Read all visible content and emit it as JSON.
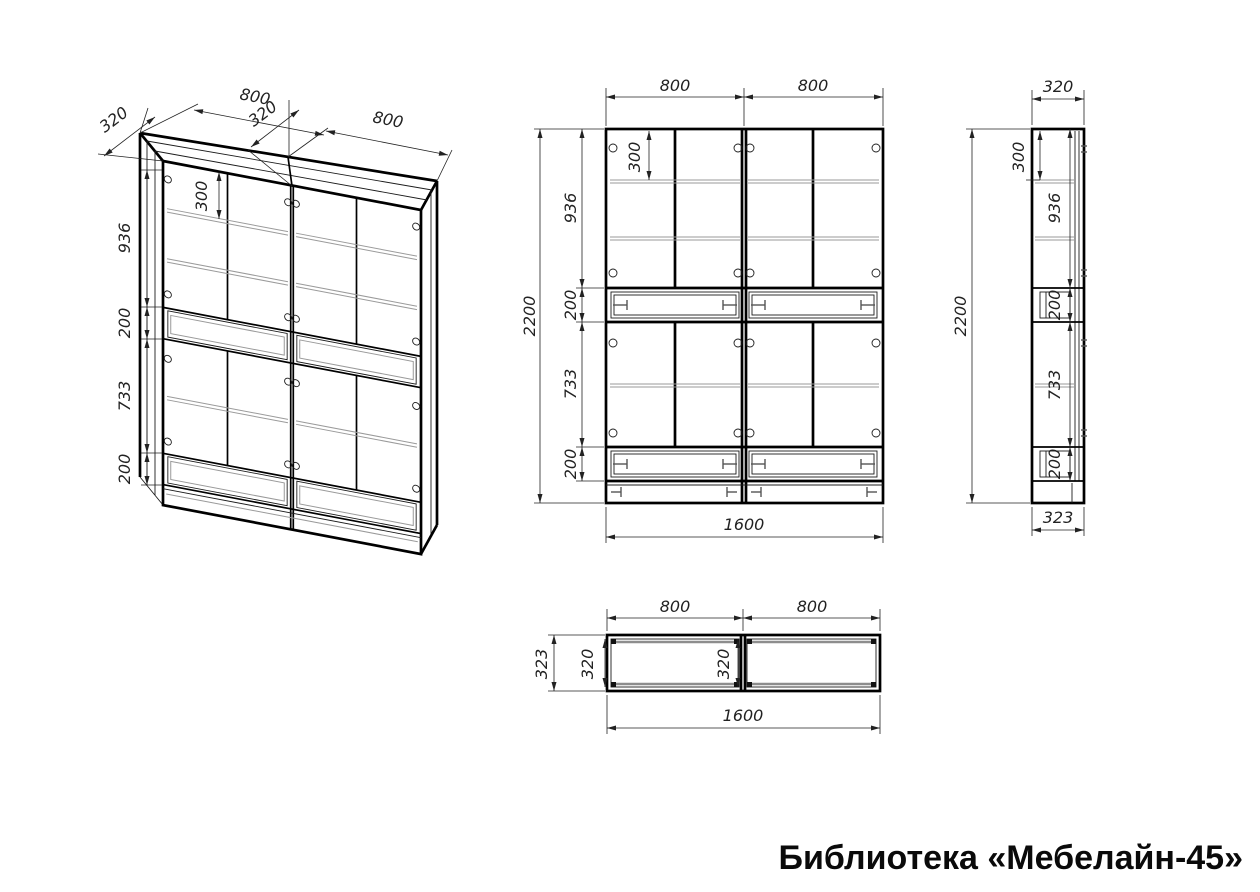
{
  "title": "Библиотека «Мебелайн-45»",
  "views": {
    "iso": {
      "label": "isometric projection",
      "dims": {
        "depth_top": "320",
        "width_left": "800",
        "depth_mid": "320",
        "width_right": "800",
        "h_top_section": "936",
        "h_drawer_upper": "200",
        "h_mid_section": "733",
        "h_drawer_lower": "200",
        "shelf_offset": "300"
      }
    },
    "front": {
      "label": "front view",
      "dims": {
        "width_left": "800",
        "width_right": "800",
        "height_total": "2200",
        "h_top_section": "936",
        "h_drawer_upper": "200",
        "h_mid_section": "733",
        "h_drawer_lower": "200",
        "shelf_offset": "300",
        "width_total": "1600"
      }
    },
    "side": {
      "label": "side view",
      "dims": {
        "depth_top": "320",
        "height_total": "2200",
        "shelf_offset": "300",
        "h_top_section": "936",
        "h_drawer_upper": "200",
        "h_mid_section": "733",
        "h_drawer_lower": "200",
        "depth_bottom": "323"
      }
    },
    "top": {
      "label": "top view",
      "dims": {
        "width_left": "800",
        "width_right": "800",
        "depth_outer": "323",
        "depth_inner": "320",
        "depth_mid": "320",
        "width_total": "1600"
      }
    }
  }
}
